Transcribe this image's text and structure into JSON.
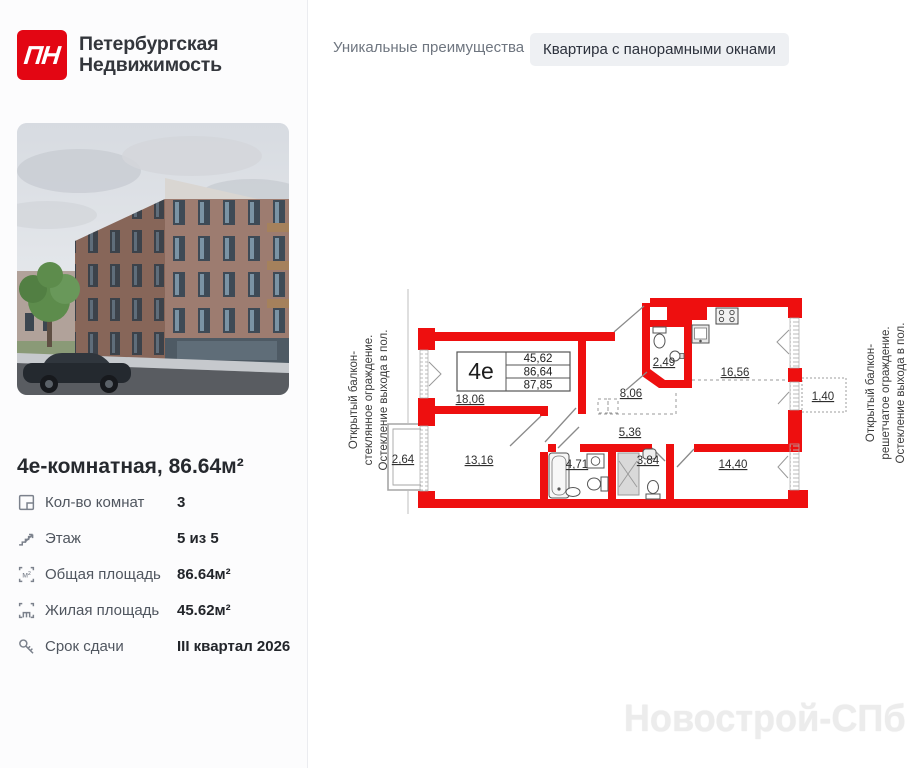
{
  "brand": {
    "logo": "ПН",
    "name_line1": "Петербургская",
    "name_line2": "Недвижимость"
  },
  "header": {
    "section_label": "Уникальные преимущества",
    "badge": "Квартира с панорамными окнами"
  },
  "listing": {
    "title": "4е-комнатная, 86.64м²",
    "details": [
      {
        "icon": "floorplan-icon",
        "label": "Кол-во комнат",
        "value": "3"
      },
      {
        "icon": "stairs-icon",
        "label": "Этаж",
        "value": "5 из 5"
      },
      {
        "icon": "total-area-icon",
        "label": "Общая площадь",
        "value": "86.64м²"
      },
      {
        "icon": "living-area-icon",
        "label": "Жилая площадь",
        "value": "45.62м²"
      },
      {
        "icon": "key-icon",
        "label": "Срок сдачи",
        "value": "III квартал 2026"
      }
    ]
  },
  "floorplan": {
    "unit_type": "4е",
    "area_summary": {
      "living": "45,62",
      "total": "86,64",
      "total_with_summer": "87,85"
    },
    "labels": {
      "room1": "18,06",
      "hallway": "8,06",
      "wc": "2,49",
      "kitchen": "16,56",
      "balcony_right": "1,40",
      "corridor": "5,36",
      "balcony_left": "2,64",
      "room2": "13,16",
      "bathroom": "4,71",
      "shower_room": "3,84",
      "room3": "14,40"
    },
    "note_left": [
      "Открытый балкон-",
      "стеклянное ограждение.",
      "Остекление выхода в пол."
    ],
    "note_right": [
      "Открытый балкон-",
      "решетчатое ограждение.",
      "Остекление выхода в пол."
    ]
  },
  "watermark": "Новострой-СПб",
  "colors": {
    "brand_red": "#e30613",
    "wall_red": "#ee0f0f",
    "badge_bg": "#eef0f3",
    "text_dark": "#26292e",
    "text_gray": "#6f7680"
  }
}
